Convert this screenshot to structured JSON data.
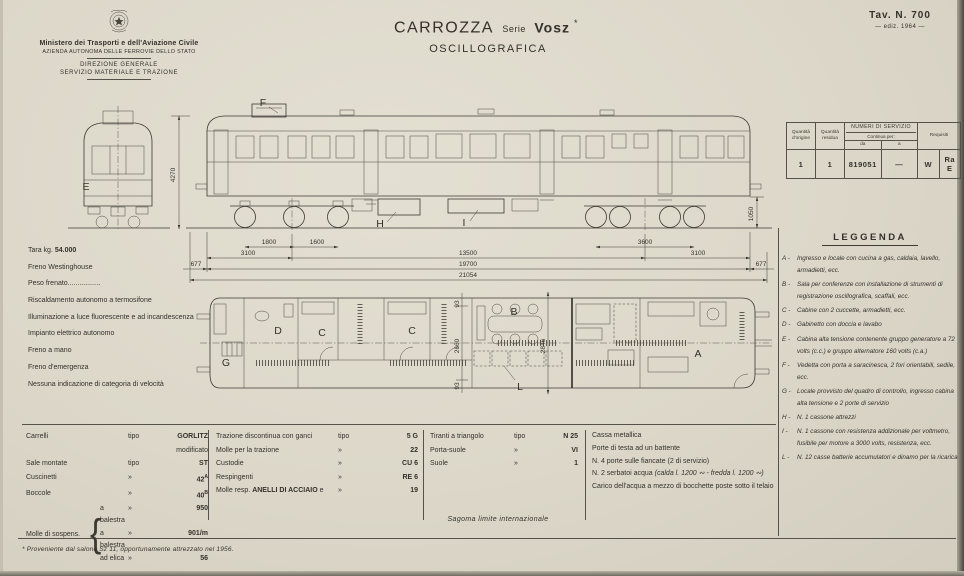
{
  "colors": {
    "paper": "#dcd7c9",
    "ink": "#33312c",
    "line": "#55524a"
  },
  "header": {
    "ministry_line1": "Ministero dei Trasporti e dell'Aviazione Civile",
    "ministry_line2": "AZIENDA AUTONOMA DELLE FERROVIE DELLO STATO",
    "ministry_line3": "DIREZIONE GENERALE",
    "ministry_line4": "SERVIZIO MATERIALE E TRAZIONE",
    "title": "CARROZZA",
    "title_serie": "Serie",
    "title_model": "Vosz",
    "title_model_sup": "*",
    "subtitle": "OSCILLOGRAFICA",
    "plate_number": "Tav. N. 700",
    "edition": "— ediz. 1964 —"
  },
  "service_table": {
    "col_origin": "Quantità d'origine",
    "col_residual": "Quantità residua",
    "col_numbers": "NUMERI DI SERVIZIO",
    "col_continua": "Continua per:",
    "col_da": "da",
    "col_a": "a",
    "col_requisiti": "Requisiti",
    "origin": "1",
    "residual": "1",
    "da": "819051",
    "a": "—",
    "req_1": "W",
    "req_2": "Ra E"
  },
  "specs": {
    "tara_pre": "Tara kg. ",
    "tara_val": "54.000",
    "items": [
      "Freno Westinghouse",
      "Peso frenato.................",
      "Riscaldamento autonomo a termosifone",
      "Illuminazione a luce fluorescente e ad incandescenza",
      "Impianto elettrico autonomo",
      "Freno a mano",
      "Freno d'emergenza",
      "Nessuna indicazione di categoria di velocità"
    ]
  },
  "legend": {
    "title": "LEGGENDA",
    "items": [
      {
        "key": "A -",
        "text": "Ingresso e locale con cucina a gas, caldaia, lavello, armadietti, ecc."
      },
      {
        "key": "B -",
        "text": "Sala per conferenze con installazione di strumenti di registrazione oscillografica, scaffali, ecc."
      },
      {
        "key": "C -",
        "text": "Cabine con 2 cuccette, armadietti, ecc."
      },
      {
        "key": "D -",
        "text": "Gabinetto con doccia e lavabo"
      },
      {
        "key": "E -",
        "text": "Cabina alta tensione contenente gruppo generatore a 72 volts (c.c.) e gruppo alternatore 160 volts (c.a.)"
      },
      {
        "key": "F -",
        "text": "Vedetta con porta a saracinesca, 2 fori orientabili, sedile, ecc."
      },
      {
        "key": "G -",
        "text": "Locale provvisto del quadro di controllo, ingresso cabina alta tensione e 2 porte di servizio"
      },
      {
        "key": "H -",
        "text": "N. 1 cassone attrezzi"
      },
      {
        "key": "I -",
        "text": "N. 1 cassone con resistenza addizionale per voltmetro, fusibile per motore a 3000 volts, resistenza, ecc."
      },
      {
        "key": "L -",
        "text": "N. 12 casse batterie accumulatori e dinamo per la ricarica"
      }
    ]
  },
  "tables": {
    "g1": {
      "brace": "{",
      "rows": [
        {
          "label": "Carrelli",
          "tipo": "tipo",
          "value_bold": "GORLITZ",
          "value_rest": " modificato"
        },
        {
          "label": "Sale montate",
          "tipo": "tipo",
          "value": "ST"
        },
        {
          "label": "Cuscinetti",
          "tipo": "»",
          "value": "42",
          "sup": "A"
        },
        {
          "label": "Boccole",
          "tipo": "»",
          "value": "40",
          "sup": "B"
        }
      ],
      "molle_label": "Molle di sospens.",
      "molle_rows": [
        {
          "label": "a balestra",
          "tipo": "»",
          "value": "950"
        },
        {
          "label": "a balestra",
          "tipo": "»",
          "value": "901/m"
        },
        {
          "label": "ad elica",
          "tipo": "»",
          "value": "56"
        }
      ]
    },
    "g2": {
      "rows": [
        {
          "label": "Trazione discontinua con ganci",
          "tipo": "tipo",
          "value": "5 G"
        },
        {
          "label": "Molle per la trazione",
          "tipo": "»",
          "value": "22"
        },
        {
          "label": "Custodie",
          "tipo": "»",
          "value": "CU 6"
        },
        {
          "label": "Respingenti",
          "tipo": "»",
          "value": "RE 6"
        }
      ],
      "row5_pre": "Molle resp. ",
      "row5_bold": "ANELLI DI ACCIAIO",
      "row5_post": " e",
      "row5_tipo": "»",
      "row5_value": "19"
    },
    "g3": {
      "rows": [
        {
          "label": "Tiranti a triangolo",
          "tipo": "tipo",
          "value": "N 25"
        },
        {
          "label": "Porta-suole",
          "tipo": "»",
          "value": "VI"
        },
        {
          "label": "Suole",
          "tipo": "»",
          "value": "1"
        }
      ]
    },
    "g4": {
      "lines": [
        "Cassa metallica",
        "Porte di testa ad un battente",
        "N. 4 porte sulle fiancate (2 di servizio)"
      ],
      "serbatoi_pre": "N. 2 serbatoi acqua ",
      "serbatoi_it": "(calda l. 1200 ∾ - fredda l. 1200 ∾)",
      "line_last": "Carico dell'acqua a mezzo di bocchette poste sotto il telaio"
    }
  },
  "drawing": {
    "letters": {
      "front": "E",
      "vedetta": "F",
      "box1": "H",
      "box2": "I",
      "plan_g": "G",
      "plan_d": "D",
      "plan_c1": "C",
      "plan_c2": "C",
      "plan_b": "B",
      "plan_l": "L",
      "plan_a": "A"
    },
    "dims": {
      "height": "4270",
      "axle1": "1800",
      "axle2": "1600",
      "bogie_right": "3600",
      "overhang_l": "3100",
      "centers": "13500",
      "overhang_r": "3100",
      "buffer_l": "677",
      "body": "19700",
      "buffer_r": "677",
      "total": "21054",
      "floor_h": "1050",
      "w_side_t": "93",
      "w_inner": "2660",
      "w_side_b": "93",
      "w_mid": "2846"
    }
  },
  "footer": {
    "sagoma": "Sagoma limite internazionale",
    "footnote": "* Proveniente dal salone Sz 11, opportunamente attrezzato nel 1956."
  }
}
